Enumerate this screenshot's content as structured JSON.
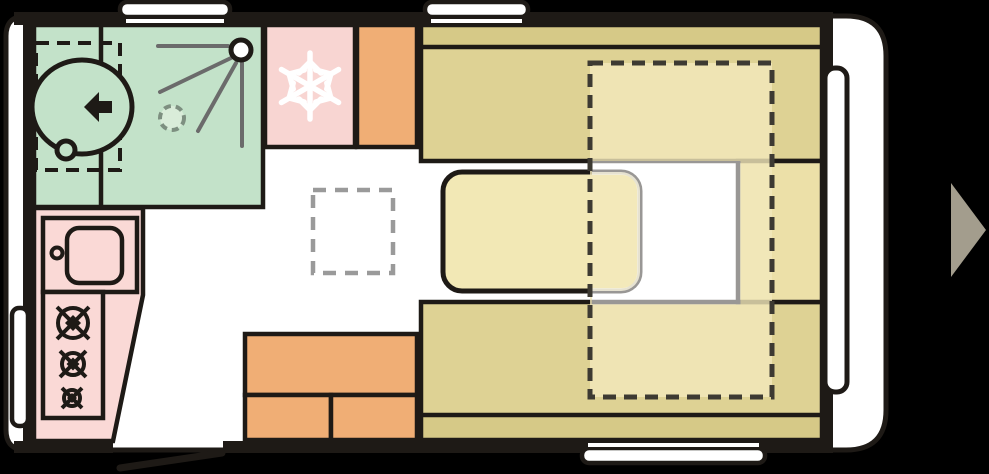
{
  "plan": {
    "title": "caravan-floorplan",
    "rooms": [
      {
        "id": "bathroom",
        "label": "washroom with shower and swivel toilet"
      },
      {
        "id": "kitchen",
        "label": "kitchen with sink and 3-burner hob"
      },
      {
        "id": "fridge",
        "label": "refrigerator"
      },
      {
        "id": "wardrobe-top",
        "label": "cabinet beside fridge"
      },
      {
        "id": "dinette",
        "label": "front lounge with two benches and table"
      },
      {
        "id": "bed-overlay",
        "label": "make-up bed outline (dashed)"
      },
      {
        "id": "roof-vent",
        "label": "roof vent (dashed floor square)"
      },
      {
        "id": "storage-bottom",
        "label": "storage chest blocks"
      },
      {
        "id": "entry-door",
        "label": "entrance door opening with swing line"
      },
      {
        "id": "direction-arrow",
        "label": "direction of travel"
      }
    ],
    "icons": [
      "snowflake-icon",
      "shower-head-icon",
      "shower-drain-icon",
      "toilet-icon",
      "toilet-arrow-icon",
      "burner-icon",
      "sink-icon",
      "faucet-icon",
      "direction-arrow-icon"
    ],
    "window_count": 5
  },
  "colors": {
    "background": "#000000",
    "outline": "#1e1a16",
    "body": "#ffffff",
    "bathroom": "#c3e2c9",
    "kitchen": "#fad9d6",
    "fridge": "#f8d5d2",
    "orange": "#f0ae75",
    "benchSeat": "#ded294",
    "benchBack": "#d6c987",
    "endBlock": "#ece0a8",
    "table": "#f2e8b5",
    "overlayCream": "rgba(242,233,188,0.8)",
    "overlayWhite": "rgba(255,255,255,0.55)",
    "bedDash": "#3d3a32",
    "ventDash": "#9a9a9a",
    "showerLine": "#6b6b6b",
    "drainFill": "#d9ecd9",
    "drainStroke": "#7d8f80",
    "snowflake": "#ffffff",
    "arrow": "#a39d8d",
    "windowFill": "#ffffff"
  }
}
